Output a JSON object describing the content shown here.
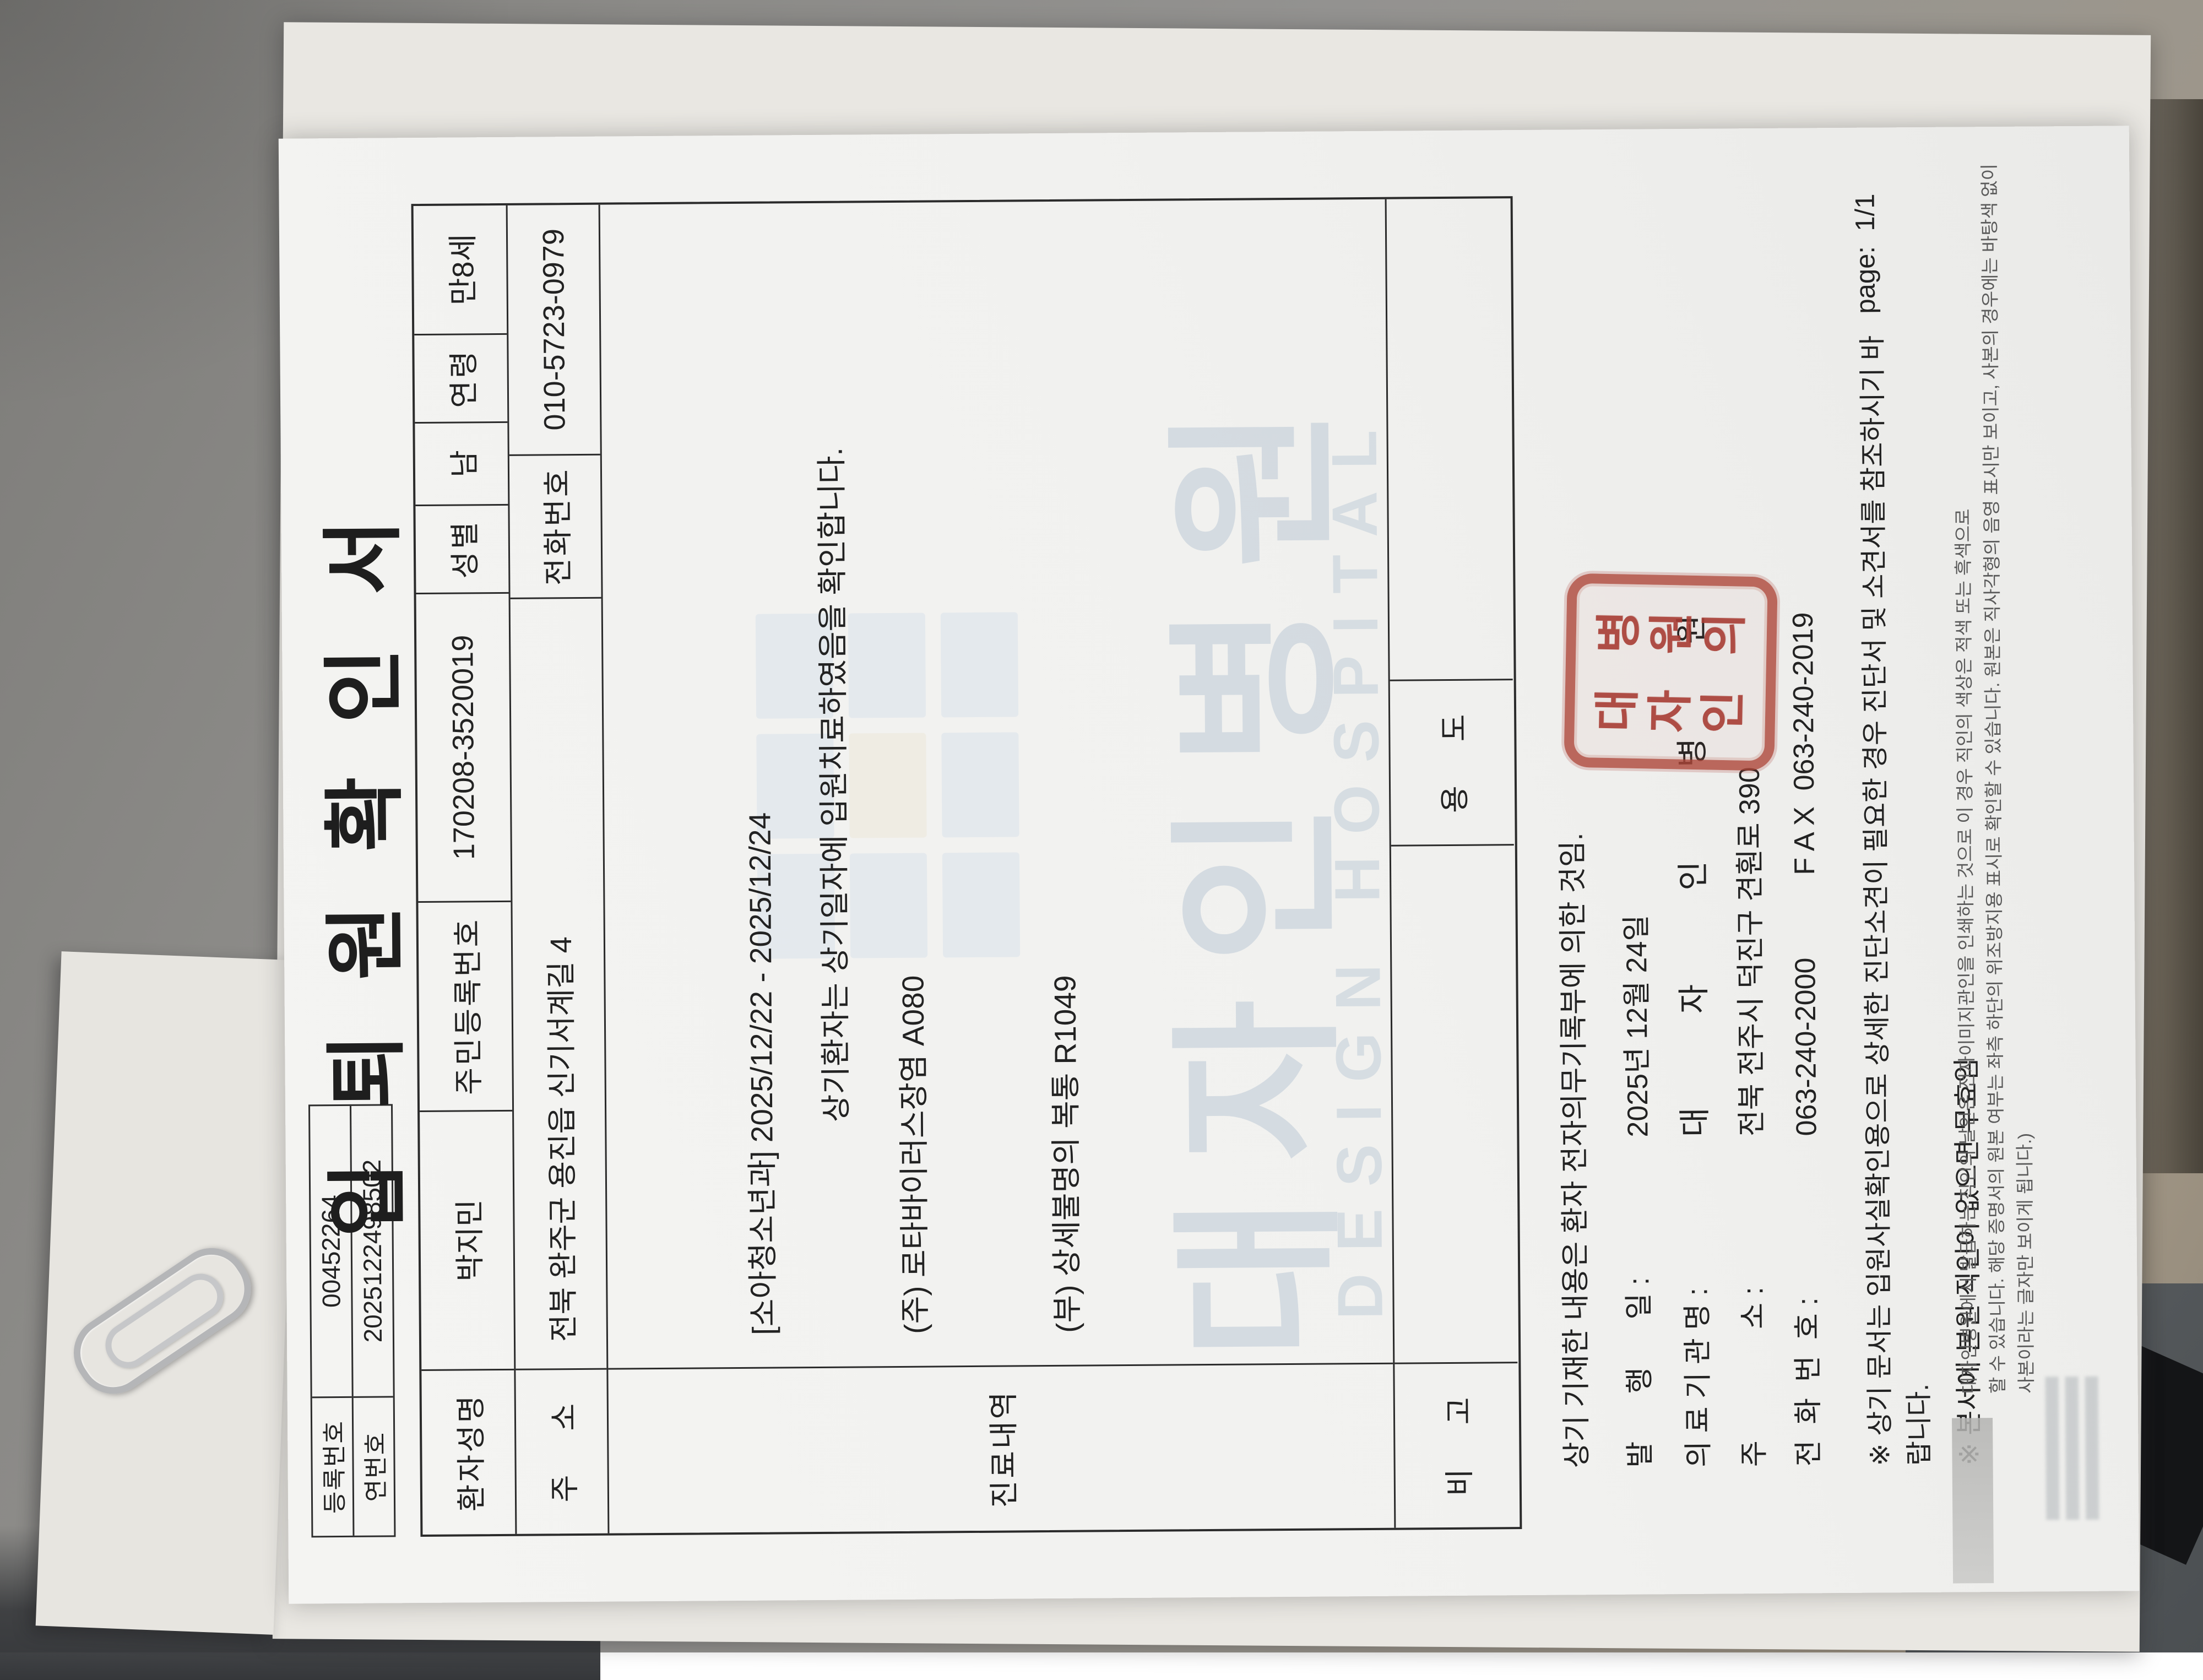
{
  "document": {
    "title": "입 퇴 원 확 인 서",
    "reg_table": {
      "reg_label": "등록번호",
      "reg_value": "00452264",
      "serial_label": "연번호",
      "serial_value": "2025122498502"
    },
    "patient_row": {
      "name_label": "환자성명",
      "name": "박지민",
      "rrn_label": "주민등록번호",
      "rrn": "170208-3520019",
      "sex_label": "성별",
      "sex": "남",
      "age_label": "연령",
      "age": "만8세"
    },
    "address_row": {
      "addr_label": "주    소",
      "addr": "전북 완주군 용진읍 신기서계길 4",
      "phone_label": "전화번호",
      "phone": "010-5723-0979"
    },
    "treatment": {
      "label": "진료내역",
      "dept_line": "[소아청소년과] 2025/12/22 - 2025/12/24",
      "dx1": "(주) 로타바이러스장염 A080",
      "dx2": "(부) 상세불명의 복통 R1049",
      "confirm": "상기환자는 상기일자에 입원치료하였음을 확인합니다."
    },
    "note_row": {
      "remark_label": "비    고",
      "purpose_label": "용    도"
    },
    "footer": {
      "basis": "상기 기재한 내용은 환자 전자의무기록부에 의한 것임.",
      "issue_label": "발      행      일 :",
      "issue_value": "2025년 12월 24일",
      "org_label": "의 료 기 관 명 :",
      "org_value": "대  자  인  병  원",
      "org_addr_label": "주              소 :",
      "org_addr": "전북 전주시 덕진구 견훤로 390",
      "org_phone_label": "전  화  번  호 :",
      "org_phone": "063-240-2000",
      "fax": "F A X  063-240-2019",
      "note1": "※ 상기 문서는 입원사실확인용으로 상세한 진단소견이 필요한 경우 진단서 및 소견서를 참조하시기 바랍니다.",
      "note2": "※ 본서에 본원 직인이 없으면 무효임",
      "page_label": "page:",
      "page_value": "1/1",
      "fine_print_1": "대자인병원에서 발급하는 직인의 날인은 전자이미지관인을 인쇄하는 것으로 이 경우 직인의 색상은 적색 또는 흑색으로",
      "fine_print_2": "할 수 있습니다. 해당 증명서의 원본 여부는 좌측 하단의 위조방지용 표시로 확인할 수 있습니다. 원본은 직사각형의 음영 표시만 보이고, 사본의 경우에는 바탕색 없이 사본이라는 글자만 보이게 됩니다.)"
    },
    "watermark": {
      "korean": "대자인병원",
      "english": "DESIGN HOSPITAL",
      "color": "#bbc9d5"
    },
    "stamp": {
      "col1": "대자인",
      "col2": "병원의",
      "color": "#a8443c"
    }
  }
}
